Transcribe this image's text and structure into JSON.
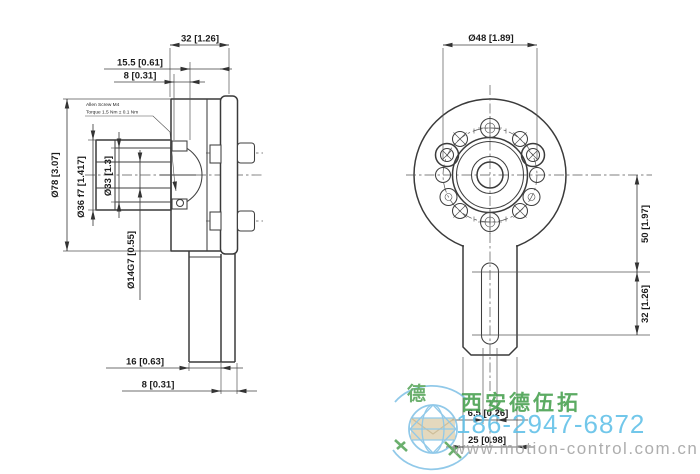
{
  "drawing_title": "encoder-dimension-drawing",
  "side_view": {
    "dims": {
      "d32": "32 [1.26]",
      "d155": "15.5 [0.61]",
      "d8top": "8 [0.31]",
      "d78": "Ø78 [3.07]",
      "d36": "Ø36 f7 [1.417]",
      "d33": "Ø33 [1.3]",
      "d14": "Ø14G7 [0.55]",
      "d16": "16 [0.63]",
      "d8bot": "8 [0.31]"
    },
    "note1": "Allen Screw M4",
    "note2": "Torque 1.5 Nm ± 0.1 Nm"
  },
  "front_view": {
    "dims": {
      "d48": "Ø48 [1.89]",
      "d50": "50 [1.97]",
      "d32": "32 [1.26]",
      "d65": "6.5 [0.26]",
      "d25": "25 [0.98]"
    }
  },
  "watermark": {
    "company": "西安德伍拓",
    "phone": "186-2947-6872",
    "website": "www.motion-control.com.cn",
    "logo_char": "德",
    "colors": {
      "company_green": "#46a04e",
      "phone_blue": "#5fc0e8",
      "website_gray": "#a3a3a3",
      "logo_blue": "#82c2e6",
      "envelope_beige": "#dbcca8"
    }
  }
}
